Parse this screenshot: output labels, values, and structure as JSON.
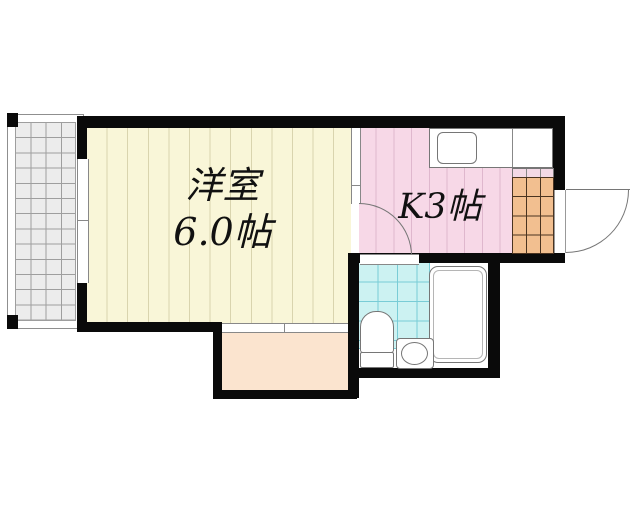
{
  "floorplan": {
    "type": "apartment-1K-floorplan",
    "rooms": {
      "western_room": {
        "label_line1": "洋室",
        "label_line2": "6.0帖"
      },
      "kitchen": {
        "label": "K3帖"
      },
      "bathroom": {
        "label": ""
      },
      "entrance": {
        "label": ""
      },
      "balcony": {
        "label": ""
      },
      "storage": {
        "label": ""
      }
    },
    "fixtures": [
      "kitchen-sink",
      "kitchen-counter",
      "bathtub",
      "toilet",
      "wash-basin",
      "entrance-door",
      "kitchen-door",
      "sliding-window-balcony",
      "sliding-window-storage",
      "bathroom-door"
    ],
    "colors": {
      "wall": "#0a0a0a",
      "room_fill": "#f9f6d8",
      "room_stripe": "#d9d4ae",
      "kitchen_fill": "#f7d8e7",
      "kitchen_stripe": "#dfb7cd",
      "bath_tile": "#ccf2f2",
      "bath_grid": "#79ccd6",
      "genkan_fill": "#f2bf90",
      "genkan_grid": "#4a3320",
      "storage_fill": "#fbe4cf",
      "balcony_fill": "#ececec",
      "balcony_grid": "#9e9e9e",
      "fixture_stroke": "#767676",
      "outline": "#8f8f8f"
    }
  }
}
